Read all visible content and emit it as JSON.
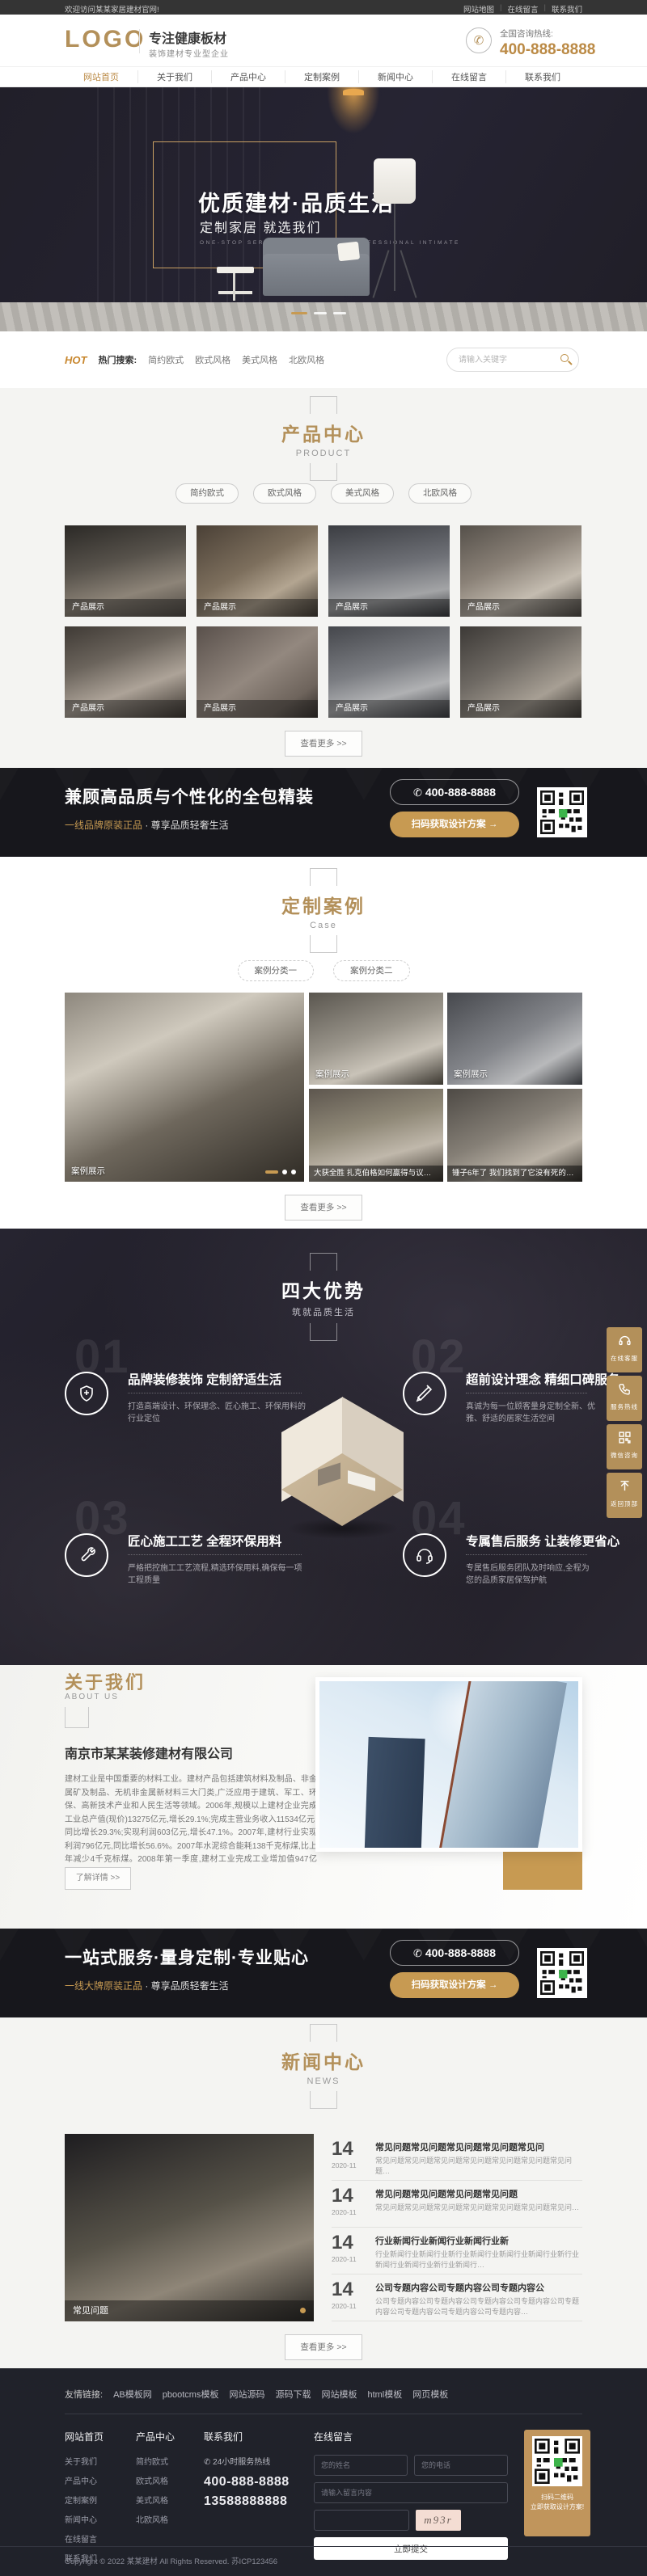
{
  "topbar": {
    "welcome": "欢迎访问某某家居建材官网!",
    "links": [
      "网站地图",
      "在线留言",
      "联系我们"
    ]
  },
  "header": {
    "logo": "LOGO",
    "slogan_main": "专注健康板材",
    "slogan_sub": "装饰建材专业型企业",
    "hotline_label": "全国咨询热线:",
    "hotline": "400-888-8888"
  },
  "nav": {
    "items": [
      "网站首页",
      "关于我们",
      "产品中心",
      "定制案例",
      "新闻中心",
      "在线留言",
      "联系我们"
    ]
  },
  "hero": {
    "title": "优质建材·品质生活",
    "subtitle": "定制家居 就选我们",
    "caption": "ONE-STOP SERVICE · TAILORED · PROFESSIONAL INTIMATE"
  },
  "hotbar": {
    "hot": "HOT",
    "label": "热门搜索:",
    "keywords": [
      "简约欧式",
      "欧式风格",
      "美式风格",
      "北欧风格"
    ],
    "search_placeholder": "请输入关键字"
  },
  "products": {
    "title": "产品中心",
    "subtitle": "PRODUCT",
    "filters": [
      "简约欧式",
      "欧式风格",
      "美式风格",
      "北欧风格"
    ],
    "items": [
      "产品展示",
      "产品展示",
      "产品展示",
      "产品展示",
      "产品展示",
      "产品展示",
      "产品展示",
      "产品展示"
    ],
    "more": "查看更多 >>"
  },
  "cta1": {
    "headline": "兼顾高品质与个性化的全包精装",
    "tagline_gold": "一线品牌原装正品",
    "tagline_rest": " · 尊享品质轻奢生活",
    "phone": "400-888-8888",
    "button": "扫码获取设计方案 →"
  },
  "cases": {
    "title": "定制案例",
    "subtitle": "Case",
    "tabs": [
      "案例分类一",
      "案例分类二"
    ],
    "big_label": "案例展示",
    "label1": "案例展示",
    "label2": "案例展示",
    "caption1": "大获全胜 扎克伯格如何赢得与议员的当",
    "caption2": "锤子6年了 我们找到了它没有死的秘密",
    "more": "查看更多 >>"
  },
  "advantages": {
    "title": "四大优势",
    "subtitle": "筑就品质生活",
    "items": [
      {
        "num": "01",
        "title": "品牌装修装饰 定制舒适生活",
        "desc": "打造高端设计、环保理念、匠心施工、环保用料的行业定位"
      },
      {
        "num": "02",
        "title": "超前设计理念 精细口碑服务",
        "desc": "真诚为每一位顾客量身定制全新、优雅、舒适的居家生活空间"
      },
      {
        "num": "03",
        "title": "匠心施工工艺 全程环保用料",
        "desc": "严格把控施工工艺流程,精选环保用料,确保每一项工程质量"
      },
      {
        "num": "04",
        "title": "专属售后服务 让装修更省心",
        "desc": "专属售后服务团队及时响应,全程为您的品质家居保驾护航"
      }
    ]
  },
  "floatbar": {
    "items": [
      "在线客服",
      "服务热线",
      "微信咨询",
      "返回顶部"
    ]
  },
  "about": {
    "title": "关于我们",
    "subtitle": "ABOUT US",
    "company": "南京市某某装修建材有限公司",
    "paragraph": "建材工业是中国重要的材料工业。建材产品包括建筑材料及制品、非金属矿及制品、无机非金属新材料三大门类,广泛应用于建筑、军工、环保、高新技术产业和人民生活等领域。2006年,规模以上建材企业完成工业总产值(现价)13275亿元,增长29.1%;完成主营业务收入11534亿元,同比增长29.3%;实现利润603亿元,增长47.1%。2007年,建材行业实现利润796亿元,同比增长56.6%。2007年水泥综合能耗138千克标煤,比上年减少4千克标煤。2008年第一季度,建材工业完成工业增加值947亿元…",
    "more": "了解详情 >>"
  },
  "cta2": {
    "headline": "一站式服务·量身定制·专业贴心",
    "tagline_gold": "一线大牌原装正品",
    "tagline_rest": " · 尊享品质轻奢生活",
    "phone": "400-888-8888",
    "button": "扫码获取设计方案 →"
  },
  "news": {
    "title": "新闻中心",
    "subtitle": "NEWS",
    "feature_label": "常见问题",
    "items": [
      {
        "day": "14",
        "date": "2020-11",
        "title": "常见问题常见问题常见问题常见问题常见问",
        "desc": "常见问题常见问题常见问题常见问题常见问题常见问题常见问题…"
      },
      {
        "day": "14",
        "date": "2020-11",
        "title": "常见问题常见问题常见问题常见问题",
        "desc": "常见问题常见问题常见问题常见问题常见问题常见问题常见问…"
      },
      {
        "day": "14",
        "date": "2020-11",
        "title": "行业新闻行业新闻行业新闻行业新",
        "desc": "行业新闻行业新闻行业新行业新闻行业新闻行业新闻行业新行业新闻行业新闻行业新行业新闻行…"
      },
      {
        "day": "14",
        "date": "2020-11",
        "title": "公司专题内容公司专题内容公司专题内容公",
        "desc": "公司专题内容公司专题内容公司专题内容公司专题内容公司专题内容公司专题内容公司专题内容公司专题内容…"
      }
    ],
    "more": "查看更多 >>"
  },
  "footer": {
    "friend_label": "友情链接:",
    "friend_links": [
      "AB模板网",
      "pbootcms模板",
      "网站源码",
      "源码下载",
      "网站模板",
      "html模板",
      "网页模板"
    ],
    "col_nav": {
      "title": "网站首页",
      "links": [
        "关于我们",
        "产品中心",
        "定制案例",
        "新闻中心",
        "在线留言",
        "联系我们"
      ]
    },
    "col_products": {
      "title": "产品中心",
      "links": [
        "简约欧式",
        "欧式风格",
        "美式风格",
        "北欧风格"
      ]
    },
    "col_contact": {
      "title": "联系我们",
      "hotline_label": "24小时服务热线",
      "phone1": "400-888-8888",
      "phone2": "13588888888"
    },
    "form": {
      "title": "在线留言",
      "name_ph": "您的姓名",
      "tel_ph": "您的电话",
      "content_ph": "请输入留言内容",
      "captcha": "m93r",
      "submit": "立即提交"
    },
    "qr_caption_1": "扫码二维码",
    "qr_caption_2": "立即获取设计方案!",
    "copyright": "Copyright © 2022 某某建材 All Rights Reserved.  苏ICP123456"
  },
  "colors": {
    "gold": "#c79a52",
    "brand": "#b3905a",
    "dark": "#17171c",
    "footer": "#20222a"
  }
}
